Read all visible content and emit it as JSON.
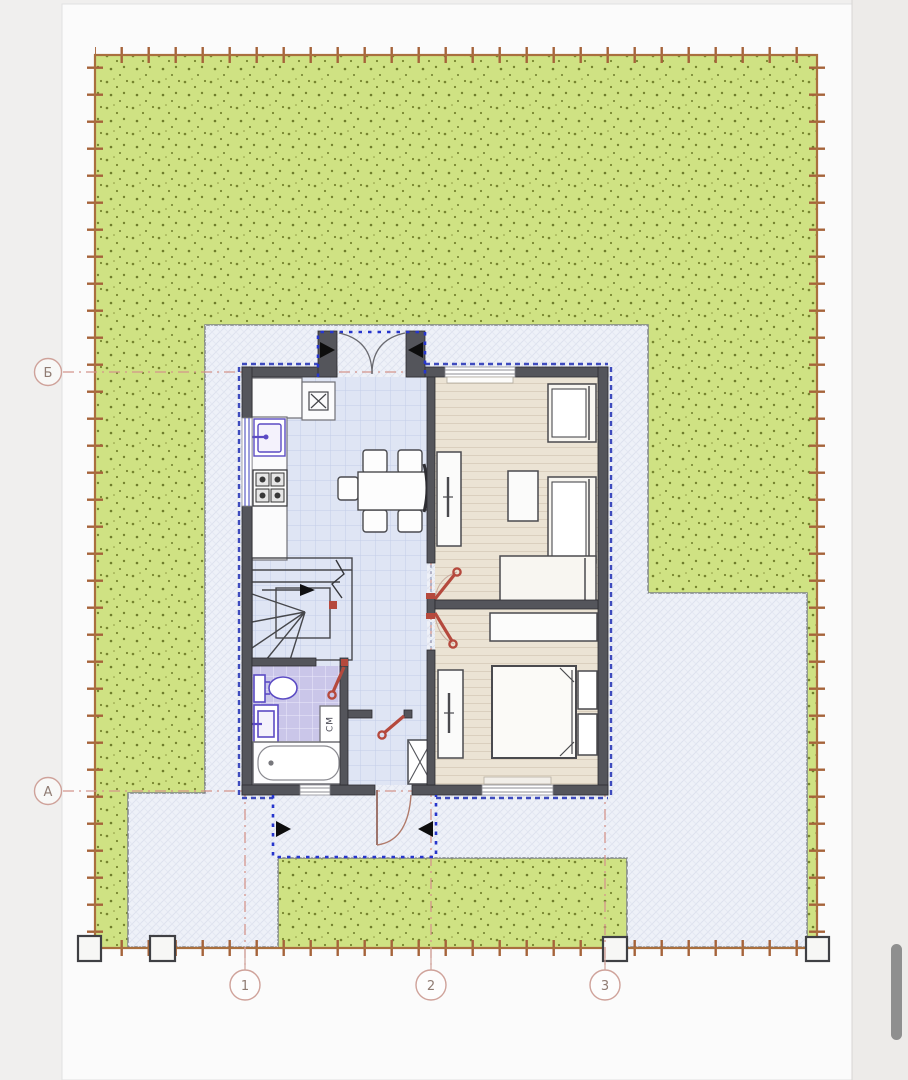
{
  "document": {
    "kind": "architectural site and floor plan drawing",
    "sheet": "single-storey house plan with garden plot"
  },
  "axes": {
    "rows": [
      {
        "label": "Б"
      },
      {
        "label": "А"
      }
    ],
    "cols": [
      {
        "label": "1"
      },
      {
        "label": "2"
      },
      {
        "label": "3"
      }
    ]
  },
  "labels": {
    "washing_machine": "СМ"
  },
  "icons": {
    "cooker_hood": "boxed-x-symbol",
    "vent_shaft": "crossed-square",
    "door_swing_marker": "red-diagonal-with-ring",
    "stair_direction": "black-arrow",
    "porch_markers": "black-triangles",
    "fence": "line-with-tick-marks"
  },
  "colors": {
    "lawn": "#cfe283",
    "lawn_speckle": "#76842f",
    "paving": "#eef1f8",
    "fence": "#a96f3e",
    "wall": "#54555b",
    "kitchen_floor": "#dfe5f4",
    "bathroom_floor": "#cac6e9",
    "bedroom_floor": "#ebe3d4",
    "insulation": "#2b3ab8",
    "porch_outline": "#2635cc",
    "door_mark": "#b5493d",
    "axis_line": "#d4958c",
    "axis_bubble": "#cfa29a",
    "plumbing": "#5b4bc4"
  },
  "viewer": {
    "scrollbar": true
  }
}
